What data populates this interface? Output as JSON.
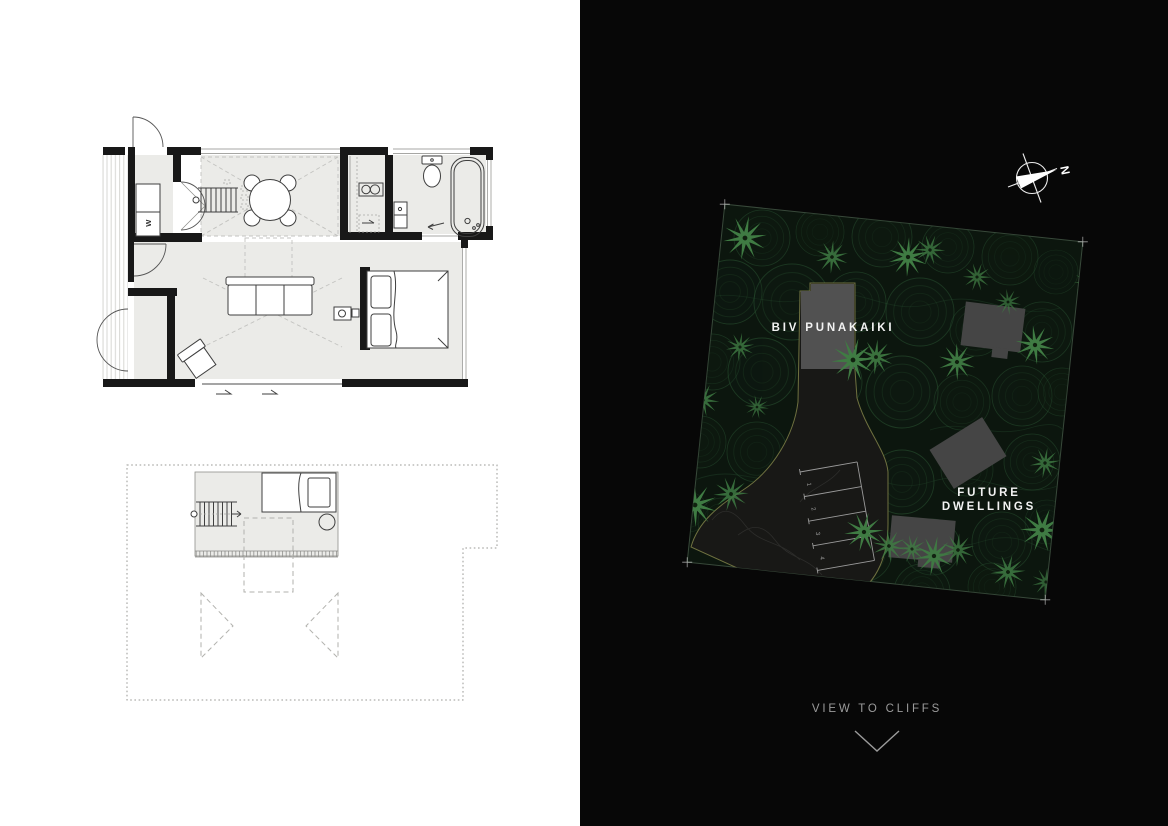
{
  "page": {
    "colors": {
      "left_bg": "#ffffff",
      "right_bg": "#070707"
    }
  },
  "floor_plan": {
    "washer_label": "W",
    "colors": {
      "wall": "#181818",
      "line": "#4b4b4b",
      "room_fill": "#ebebe8",
      "dash": "#c3c3c0",
      "deck_line": "#d7d7d3"
    }
  },
  "site_plan": {
    "labels": {
      "building": "BIV PUNAKAIKI",
      "future_line1": "FUTURE",
      "future_line2": "DWELLINGS",
      "view_to_cliffs": "VIEW TO CLIFFS",
      "north": "N"
    },
    "parking_labels": [
      "1",
      "2",
      "3",
      "4"
    ],
    "colors": {
      "site_fill": "#0c160e",
      "canopy": "#2b5634",
      "palm": "#3f7b43",
      "building": "#454545",
      "driveway": "#181816",
      "boundary": "#6f7140",
      "label": "#f2f2f2",
      "muted_label": "#9b9b9b",
      "parking_line": "#9a9a9a"
    }
  }
}
